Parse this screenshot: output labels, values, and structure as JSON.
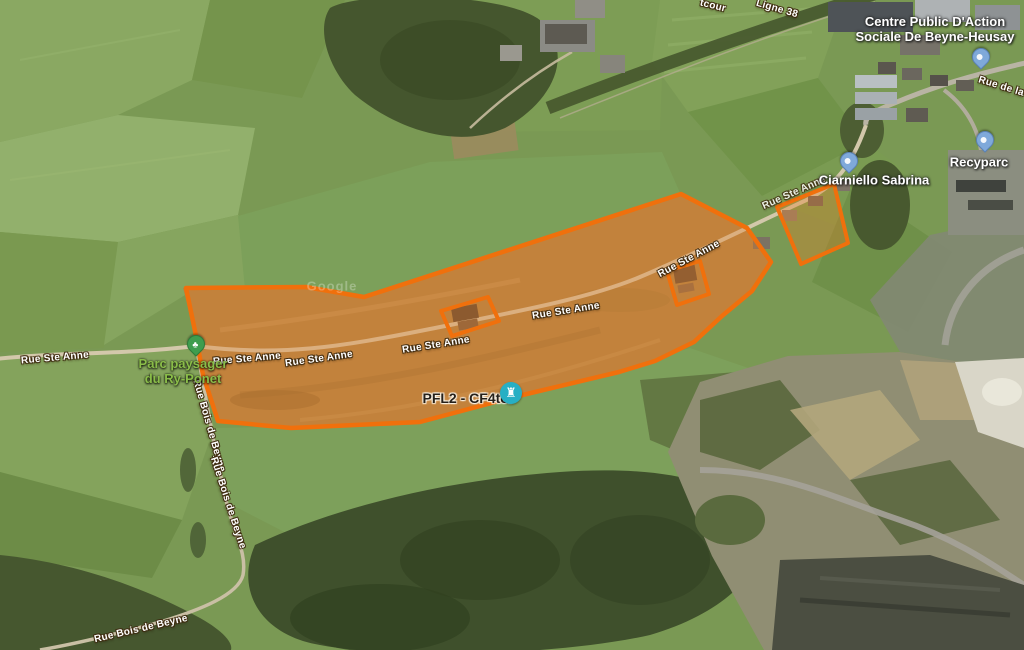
{
  "map": {
    "attribution_watermark": "Google",
    "road_labels": {
      "rue_ste_anne": "Rue Ste Anne",
      "rue_bois_de_beyne": "Rue Bois de Beyne",
      "ligne_38": "Ligne 38",
      "rue_de_la_s_partial": "Rue de la S",
      "tcour_partial": "tcour"
    },
    "place_labels": {
      "cpas_line1": "Centre Public D'Action",
      "cpas_line2": "Sociale De Beyne-Heusay",
      "recyparc": "Recyparc",
      "ciarniello_sabrina": "Ciarniello Sabrina",
      "parc_line1": "Parc paysager",
      "parc_line2": "du Ry-Ponet",
      "pfl2_cf4ter": "PFL2 - CF4ter"
    },
    "markers": {
      "cpas_pin": "blue-place-pin",
      "ciarniello_pin": "blue-place-pin",
      "recyparc_pin": "blue-place-pin",
      "park_pin": "green-park-pin",
      "pfl2_marker": "teal-tower-marker"
    },
    "overlay": {
      "zone_stroke_color": "#f0700c",
      "zone_fill_color": "rgba(237,125,35,0.32)"
    },
    "marker_colors": {
      "place_pin_blue": "#7fa9da",
      "park_pin_green": "#3e9d4e",
      "pfl2_marker_teal": "#27afc4"
    }
  }
}
